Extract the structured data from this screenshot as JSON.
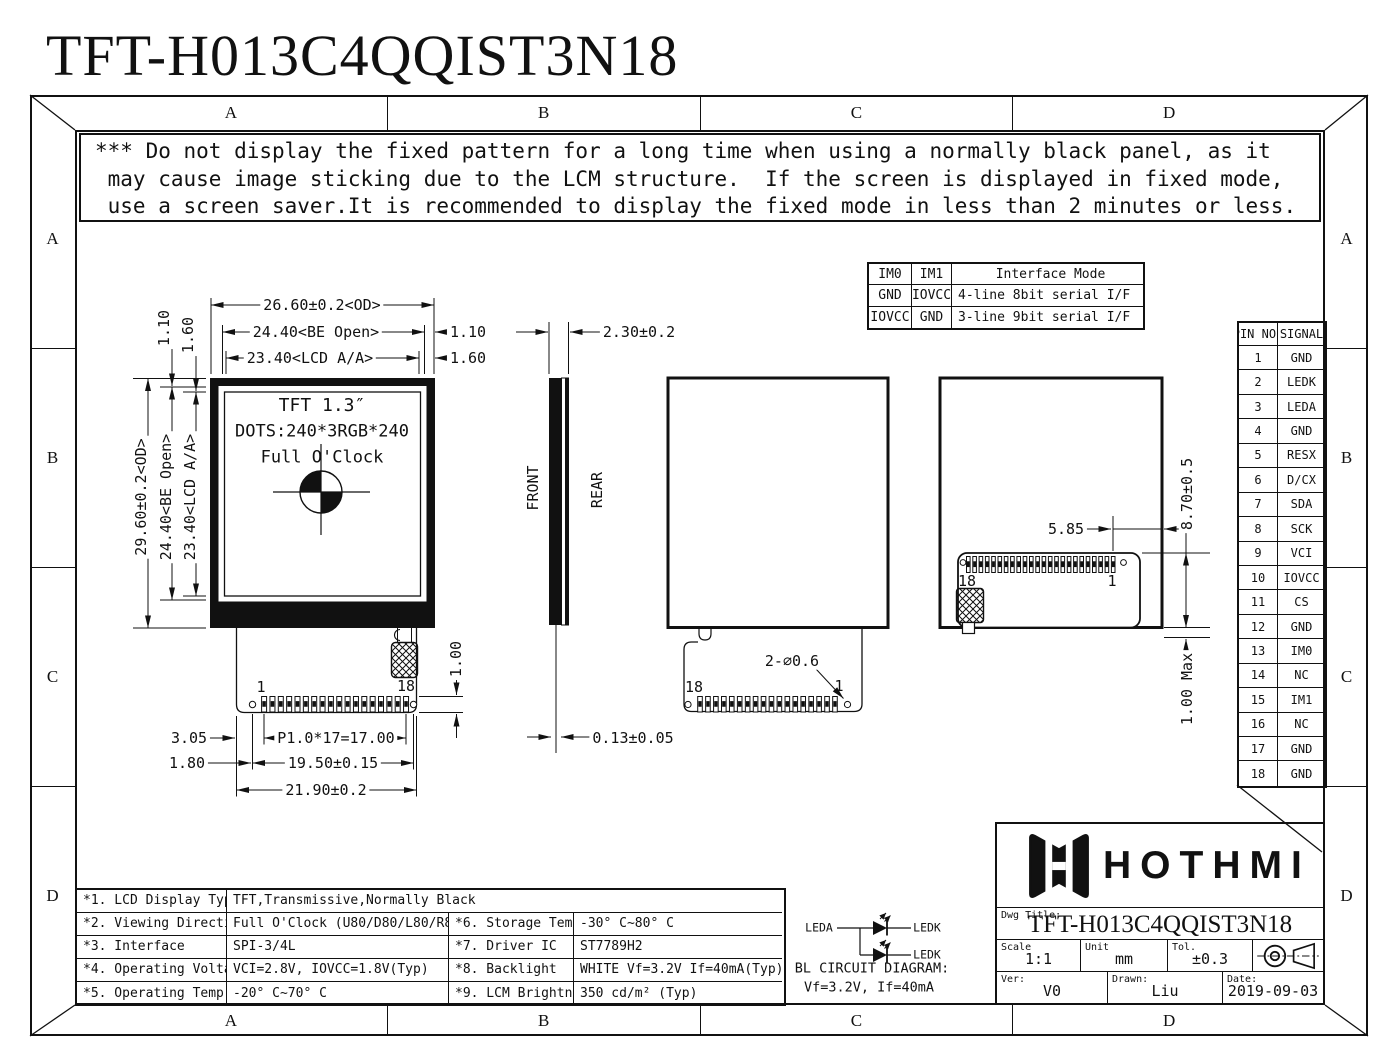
{
  "page_title": "TFT-H013C4QQIST3N18",
  "frame": {
    "cols": [
      "A",
      "B",
      "C",
      "D"
    ],
    "rows": [
      "A",
      "B",
      "C",
      "D"
    ]
  },
  "warning": {
    "line1": "*** Do not display the fixed pattern for a long time when using a normally black panel, as it",
    "line2": " may cause image sticking due to the LCM structure.  If the screen is displayed in fixed mode,",
    "line3": " use a screen saver.It is recommended to display the fixed mode in less than 2 minutes or less."
  },
  "interface_table": {
    "h1": "IM0",
    "h2": "IM1",
    "h3": "Interface Mode",
    "r1c1": "GND",
    "r1c2": "IOVCC",
    "r1c3": "4-line 8bit serial I/F",
    "r2c1": "IOVCC",
    "r2c2": "GND",
    "r2c3": "3-line 9bit serial I/F"
  },
  "pin_table": {
    "h1": "PIN NO.",
    "h2": "SIGNAL",
    "pins": [
      [
        "1",
        "GND"
      ],
      [
        "2",
        "LEDK"
      ],
      [
        "3",
        "LEDA"
      ],
      [
        "4",
        "GND"
      ],
      [
        "5",
        "RESX"
      ],
      [
        "6",
        "D/CX"
      ],
      [
        "7",
        "SDA"
      ],
      [
        "8",
        "SCK"
      ],
      [
        "9",
        "VCI"
      ],
      [
        "10",
        "IOVCC"
      ],
      [
        "11",
        "CS"
      ],
      [
        "12",
        "GND"
      ],
      [
        "13",
        "IM0"
      ],
      [
        "14",
        "NC"
      ],
      [
        "15",
        "IM1"
      ],
      [
        "16",
        "NC"
      ],
      [
        "17",
        "GND"
      ],
      [
        "18",
        "GND"
      ]
    ]
  },
  "front_view": {
    "dim_width_od": "26.60±0.2<OD>",
    "dim_width_be": "24.40<BE Open>",
    "dim_width_aa": "23.40<LCD A/A>",
    "dim_right_gap1": "1.10",
    "dim_right_gap2": "1.60",
    "dim_height_od": "29.60±0.2<OD>",
    "dim_height_be": "24.40<BE Open>",
    "dim_height_aa": "23.40<LCD A/A>",
    "dim_top_gap1": "1.10",
    "dim_top_gap2": "1.60",
    "screen_line1": "TFT 1.3″",
    "screen_line2": "DOTS:240*3RGB*240",
    "screen_line3": "Full O'Clock",
    "pin_first": "1",
    "pin_last": "18",
    "dim_pin_offset": "3.05",
    "dim_pitch": "P1.0*17=17.00",
    "dim_hole_offset": "1.80",
    "dim_hole_span": "19.50±0.15",
    "dim_fpc_width": "21.90±0.2",
    "dim_pin_len": "1.00"
  },
  "side_view": {
    "dim_thickness": "2.30±0.2",
    "label_front": "FRONT",
    "label_rear": "REAR",
    "dim_film": "0.13±0.05"
  },
  "rear_view_center": {
    "pin_left": "18",
    "pin_right": "1",
    "dim_holes": "2-∅0.6"
  },
  "rear_view_right": {
    "pin_left": "18",
    "pin_right": "1",
    "dim_edge": "5.85",
    "dim_fold": "8.70±0.5",
    "dim_gap": "1.00 Max"
  },
  "bl_circuit": {
    "label_leda": "LEDA",
    "label_ledk1": "LEDK",
    "label_ledk2": "LEDK",
    "caption1": "BL CIRCUIT DIAGRAM:",
    "caption2": "Vf=3.2V, If=40mA"
  },
  "spec_table": {
    "r1_label": "*1. LCD Display Type",
    "r1_value": "TFT,Transmissive,Normally Black",
    "r2_label": "*2. Viewing Direction",
    "r2_value": "Full O'Clock (U80/D80/L80/R80)",
    "r2_label2": "*6. Storage Temp",
    "r2_value2": "-30° C~80° C",
    "r3_label": "*3. Interface",
    "r3_value": "SPI-3/4L",
    "r3_label2": "*7. Driver IC",
    "r3_value2": "ST7789H2",
    "r4_label": "*4. Operating Voltage",
    "r4_value": "VCI=2.8V, IOVCC=1.8V(Typ)",
    "r4_label2": "*8. Backlight",
    "r4_value2": "WHITE Vf=3.2V If=40mA(Typ)",
    "r5_label": "*5. Operating Temp",
    "r5_value": "-20° C~70° C",
    "r5_label2": "*9. LCM Brightness",
    "r5_value2": "350 cd/m² (Typ)"
  },
  "title_block": {
    "brand": "HOTHMI",
    "dwg_title_label": "Dwg Title:",
    "dwg_title": "TFT-H013C4QQIST3N18",
    "scale_label": "Scale",
    "scale_value": "1:1",
    "unit_label": "Unit",
    "unit_value": "mm",
    "tol_label": "Tol.",
    "tol_value": "±0.3",
    "ver_label": "Ver:",
    "ver_value": "V0",
    "drawn_label": "Drawn:",
    "drawn_value": "Liu",
    "date_label": "Date:",
    "date_value": "2019-09-03"
  }
}
